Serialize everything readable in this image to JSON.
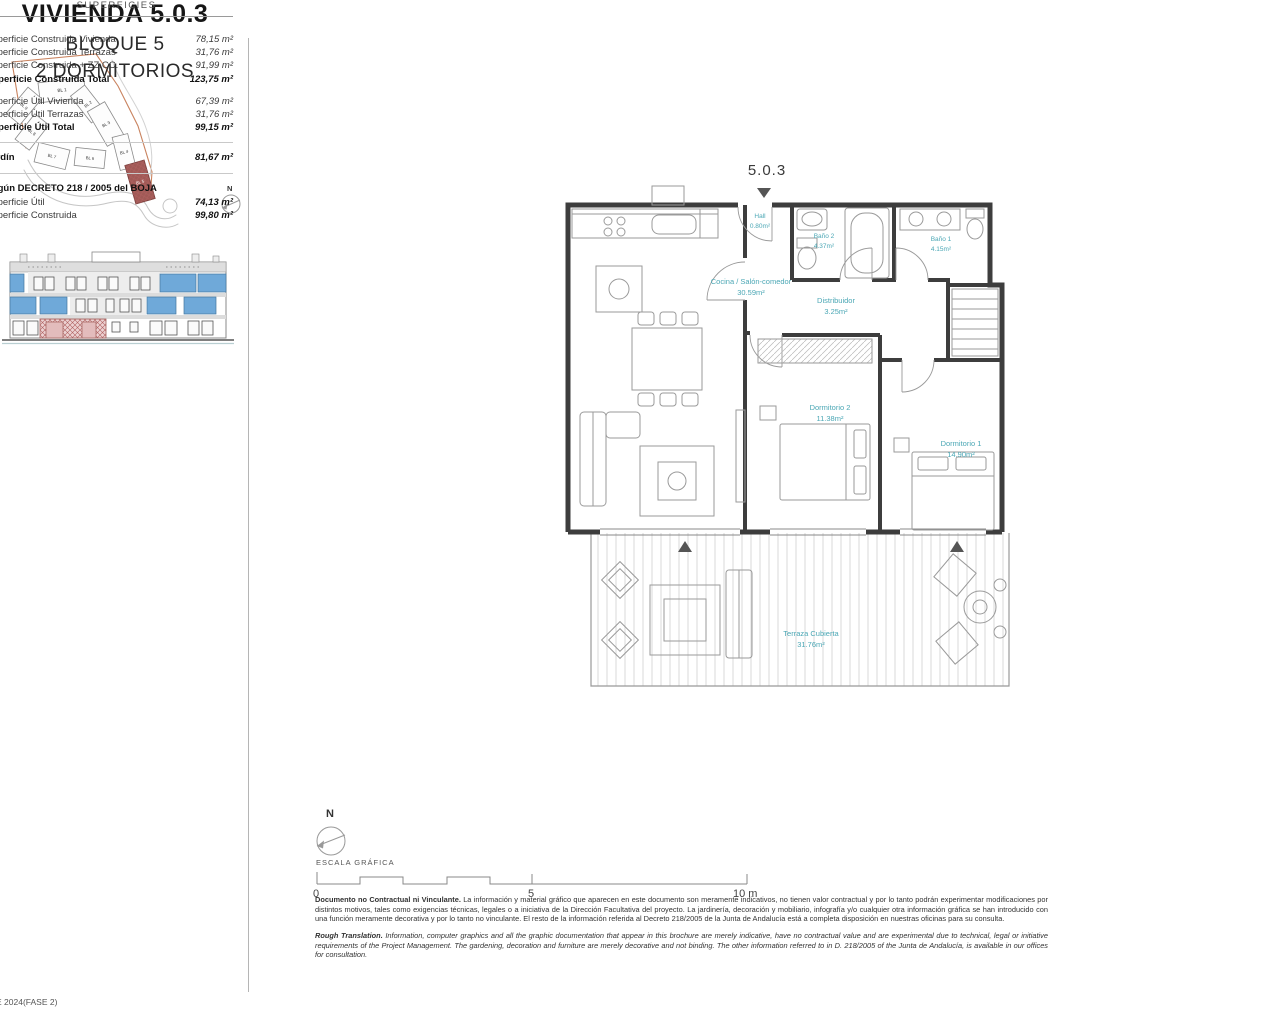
{
  "page": {
    "footer_code": "E 2024(FASE 2)"
  },
  "title_block": {
    "title": "VIVIENDA 5.0.3",
    "subtitle1": "BLOQUE 5",
    "subtitle2": "2 DORMITORIOS"
  },
  "surfaces": {
    "header": "SUPERFICIES",
    "rows": [
      {
        "label": "Superficie Construida Vivienda",
        "value": "78,15 m²"
      },
      {
        "label": "Superficie Construida Terrazas",
        "value": "31,76 m²"
      },
      {
        "label": "Superficie Construida + ZZ.CC.",
        "value": "91,99 m²"
      },
      {
        "label": "Superficie Construida Total",
        "value": "123,75 m²"
      },
      {
        "label": "Superficie Útil Vivienda",
        "value": "67,39 m²"
      },
      {
        "label": "Superficie Útil Terrazas",
        "value": "31,76 m²"
      },
      {
        "label": "Superficie Útil Total",
        "value": "99,15 m²"
      }
    ],
    "jardin": {
      "label": "Jardín",
      "value": "81,67 m²"
    },
    "decreto_header": "Según DECRETO 218 / 2005 del BOJA",
    "decreto_rows": [
      {
        "label": "Superficie Útil",
        "value": "74,13 m²"
      },
      {
        "label": "Superficie Construida",
        "value": "99,80 m²"
      }
    ]
  },
  "plan": {
    "unit_label": "5.0.3",
    "rooms": [
      {
        "name": "Hall",
        "area": "0.80m²"
      },
      {
        "name": "Cocina / Salón-comedor",
        "area": "30.59m²"
      },
      {
        "name": "Baño 2",
        "area": "4.37m²"
      },
      {
        "name": "Baño 1",
        "area": "4.15m²"
      },
      {
        "name": "Distribuidor",
        "area": "3.25m²"
      },
      {
        "name": "Dormitorio 2",
        "area": "11.38m²"
      },
      {
        "name": "Dormitorio 1",
        "area": "14.90m²"
      },
      {
        "name": "Terraza Cubierta",
        "area": "31.76m²"
      }
    ]
  },
  "site_plan": {
    "highlighted": "BL 5",
    "blocks": [
      {
        "label": "BL 1"
      },
      {
        "label": "BL 2"
      },
      {
        "label": "BL 3"
      },
      {
        "label": "BL 4"
      },
      {
        "label": "BL 5"
      },
      {
        "label": "BL 6"
      },
      {
        "label": "BL 7"
      },
      {
        "label": "BL 8"
      },
      {
        "label": "BL 9"
      }
    ]
  },
  "compass": {
    "label": "N"
  },
  "scale_bar": {
    "title": "ESCALA GRÁFICA",
    "ticks": [
      {
        "t": "0"
      },
      {
        "t": "5"
      },
      {
        "t": "10 m"
      }
    ]
  },
  "disclaimer": {
    "es_lead": "Documento no Contractual ni Vinculante.",
    "es_body": " La información y material gráfico que aparecen en este documento son meramente indicativos, no tienen valor contractual y por lo tanto podrán experimentar modificaciones por distintos motivos, tales como exigencias técnicas, legales o a iniciativa de la Dirección Facultativa del proyecto. La jardinería, decoración y mobiliario, infografía y/o cualquier otra información gráfica se han introducido con una función meramente decorativa y por lo tanto no vinculante. El resto de la información referida al Decreto 218/2005 de la Junta de Andalucía está a completa disposición en nuestras oficinas para su consulta.",
    "en_lead": "Rough Translation.",
    "en_body": " Information, computer graphics and all the graphic documentation that appear in this brochure are merely indicative, have no contractual value and are experimental due to technical, legal or initiative requirements of the Project Management. The gardening, decoration and furniture are merely decorative and not binding. The other information referred to in D. 218/2005 of the Junta de Andalucía, is available in our offices for consultation."
  },
  "colors": {
    "room_label": "#4BA7B5",
    "wall": "#3D3D3D",
    "window_blue": "#6FA9D9",
    "highlight_red": "#A05A56",
    "boundary_orange": "#C9835F"
  }
}
